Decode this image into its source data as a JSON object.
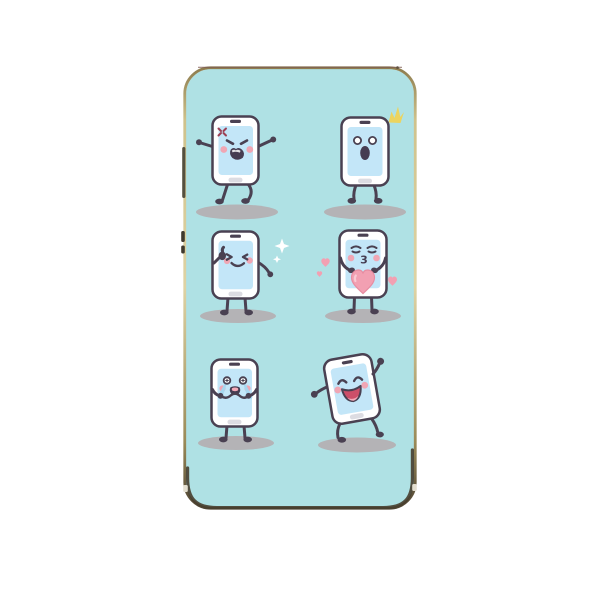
{
  "image": {
    "kind": "product-photo",
    "subject": "smartphone case printed with six cartoon phone emoji characters on a mint background"
  },
  "colors": {
    "background_page": "#ffffff",
    "case_interior": "#afe1e4",
    "frame_gold": "#d8cc9c",
    "frame_dark": "#473e2e",
    "outline": "#4a4152",
    "phone_body": "#ffffff",
    "screen": "#c3e6f8",
    "cheek": "#f0a6b4",
    "heart": "#f2a0b2",
    "heart_outline": "#e78ca1",
    "mouth_dark": "#463d52",
    "laugh_mouth": "#cc4f69",
    "tongue": "#f4a9b8",
    "tears": "#a7d6ef",
    "sparkle_yellow": "#ecd45e",
    "sparkle_white": "#ffffff",
    "anger_mark": "#9c3f53",
    "shadow": "#b4b3b6",
    "home_button": "#dcdce2"
  },
  "characters": [
    {
      "name": "angry-phone",
      "emotion": "angry",
      "row": 1,
      "col": 1
    },
    {
      "name": "surprised-phone",
      "emotion": "surprised",
      "row": 1,
      "col": 2
    },
    {
      "name": "winking-phone",
      "emotion": "wink-thumbs-up",
      "row": 2,
      "col": 1
    },
    {
      "name": "kissing-phone",
      "emotion": "blowing-kiss-with-heart",
      "row": 2,
      "col": 2,
      "mouth_glyph": "3"
    },
    {
      "name": "crying-phone",
      "emotion": "crying",
      "row": 3,
      "col": 1
    },
    {
      "name": "dancing-phone",
      "emotion": "laughing-dancing",
      "row": 3,
      "col": 2
    }
  ]
}
